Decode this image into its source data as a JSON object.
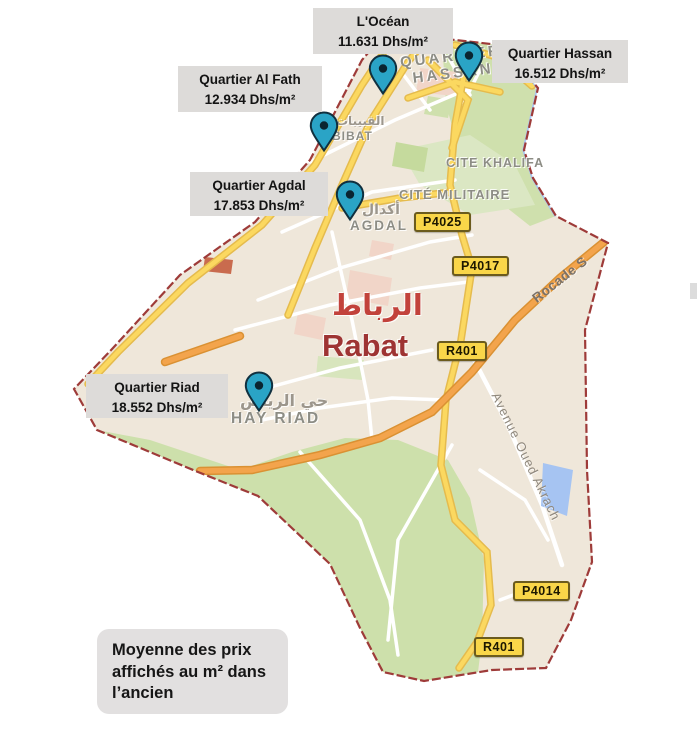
{
  "markers": [
    {
      "area": "L'Océan",
      "price": "11.631 Dhs/m²"
    },
    {
      "area": "Quartier Hassan",
      "price": "16.512 Dhs/m²"
    },
    {
      "area": "Quartier Al Fath",
      "price": "12.934 Dhs/m²"
    },
    {
      "area": "Quartier Agdal",
      "price": "17.853 Dhs/m²"
    },
    {
      "area": "Quartier Riad",
      "price": "18.552 Dhs/m²"
    }
  ],
  "caption": {
    "line1": "Moyenne des prix",
    "line2": "affichés au m² dans",
    "line3": "l’ancien"
  },
  "map_labels": {
    "quartier_hassan_line1": "QUARTIER",
    "quartier_hassan_line2": "HASSAN",
    "qbibat_ar": "القبيبات",
    "qbibat": "BIBAT",
    "cite_khalifa": "CITE KHALIFA",
    "cite_militaire": "CITÉ MILITAIRE",
    "agdal_ar": "أكدال",
    "agdal": "AGDAL",
    "rabat_ar": "الرباط",
    "rabat": "Rabat",
    "hay_riad_ar": "حي الرياض",
    "hay_riad": "HAY RIAD"
  },
  "roads": {
    "badges": [
      {
        "ref": "P4025"
      },
      {
        "ref": "P4017"
      },
      {
        "ref": "R401"
      },
      {
        "ref": "P4014"
      },
      {
        "ref": "R401"
      }
    ],
    "rocade": "Rocade S",
    "avenue": "Avenue Oued Akrach"
  },
  "colors": {
    "pin_fill": "#2aa4c6",
    "boundary": "#9e3b39",
    "label_box_bg": "#dddbd9",
    "badge_bg": "#f9d649",
    "rabat_text": "#9e3433",
    "park_green": "#cfe0ad",
    "highway_orange": "#f3a44c",
    "road_yellow": "#fbd860"
  }
}
